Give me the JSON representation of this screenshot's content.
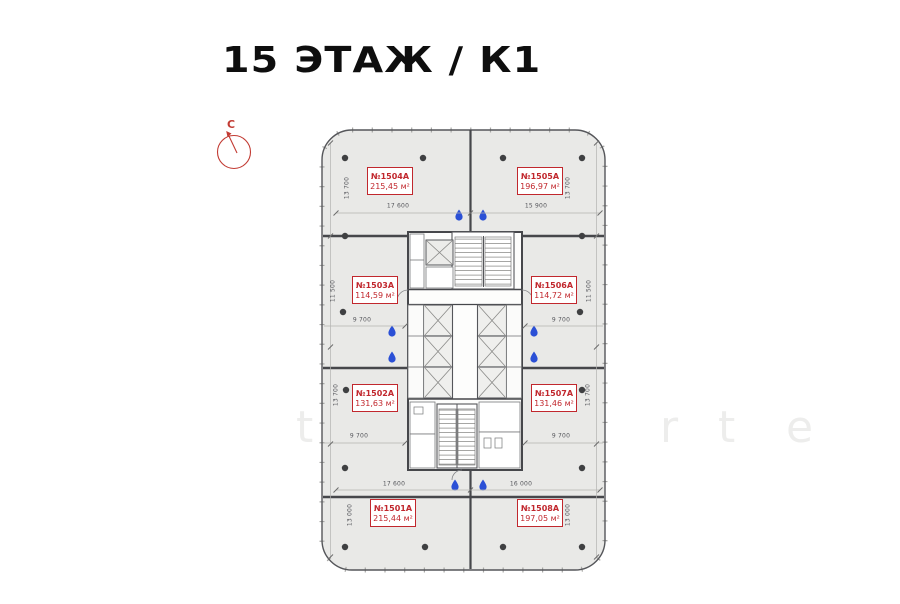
{
  "title": "15 ЭТАЖ / К1",
  "compass": {
    "north_label": "С"
  },
  "units": [
    {
      "number": "№1501А",
      "area": "215,44 м²"
    },
    {
      "number": "№1502А",
      "area": "131,63 м²"
    },
    {
      "number": "№1503А",
      "area": "114,59 м²"
    },
    {
      "number": "№1504А",
      "area": "215,45 м²"
    },
    {
      "number": "№1505А",
      "area": "196,97 м²"
    },
    {
      "number": "№1506А",
      "area": "114,72 м²"
    },
    {
      "number": "№1507А",
      "area": "131,46 м²"
    },
    {
      "number": "№1508А",
      "area": "197,05 м²"
    }
  ],
  "dimensions": {
    "top_left": "17 600",
    "top_right": "15 900",
    "bottom_left": "17 600",
    "bottom_right": "16 000",
    "side_top": "13 700",
    "side_mid": "11 500",
    "side_third": "13 700",
    "side_bottom": "13 000",
    "wing_width": "9 700"
  },
  "watermark": {
    "letters": [
      "t",
      "e",
      "x",
      "r",
      "t",
      "e"
    ]
  },
  "colors": {
    "accent_red": "#c1272d",
    "drop_blue": "#2b50d6",
    "wall_gray": "#46474b",
    "plan_fill": "#e9e9e7"
  }
}
